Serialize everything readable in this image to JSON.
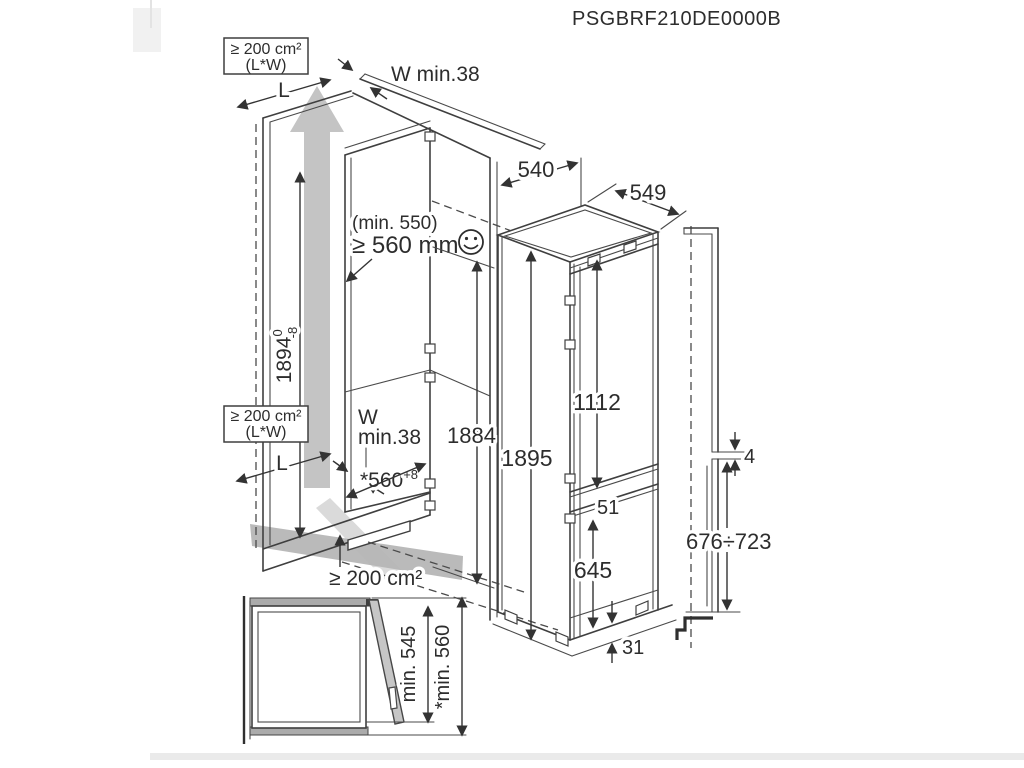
{
  "title": "PSGBRF210DE0000B",
  "colors": {
    "line": "#3f3f3f",
    "text": "#2d2d2d",
    "airflow_arrow": "#c4c4c4",
    "floor_shadow": "#a3a3a3",
    "panel_gray": "#ababab"
  },
  "icons": {
    "depth_ok": "smiley-face"
  },
  "niche_view": {
    "top_vent_box": {
      "line1": "≥ 200 cm²",
      "line2": "(L*W)"
    },
    "mid_vent_box": {
      "line1": "≥ 200 cm²",
      "line2": "(L*W)"
    },
    "length_label_top": "L",
    "length_label_mid": "L",
    "top_gap_label": "W min.38",
    "mid_gap_label_line1": "W",
    "mid_gap_label_line2": "min.38",
    "depth_note": "(min. 550)",
    "depth_min": "≥ 560 mm",
    "niche_height": {
      "value": "1894",
      "tol_upper": "0",
      "tol_lower": "-8"
    },
    "niche_depth": {
      "value": "*560",
      "tol": "+8"
    },
    "inner_height": "1884",
    "bottom_vent_label": "≥ 200 cm²",
    "top_depth": "540"
  },
  "appliance_view": {
    "width": "549",
    "height": "1895",
    "upper_door_height": "1112",
    "door_gap": "51",
    "lower_door_height": "645",
    "plinth_height": "31"
  },
  "panel_section_view": {
    "panel_gap": "4",
    "lower_panel_height_range": "676÷723"
  },
  "plan_view": {
    "min_depth": "min. 545",
    "min_depth_with_panel": "*min. 560"
  }
}
